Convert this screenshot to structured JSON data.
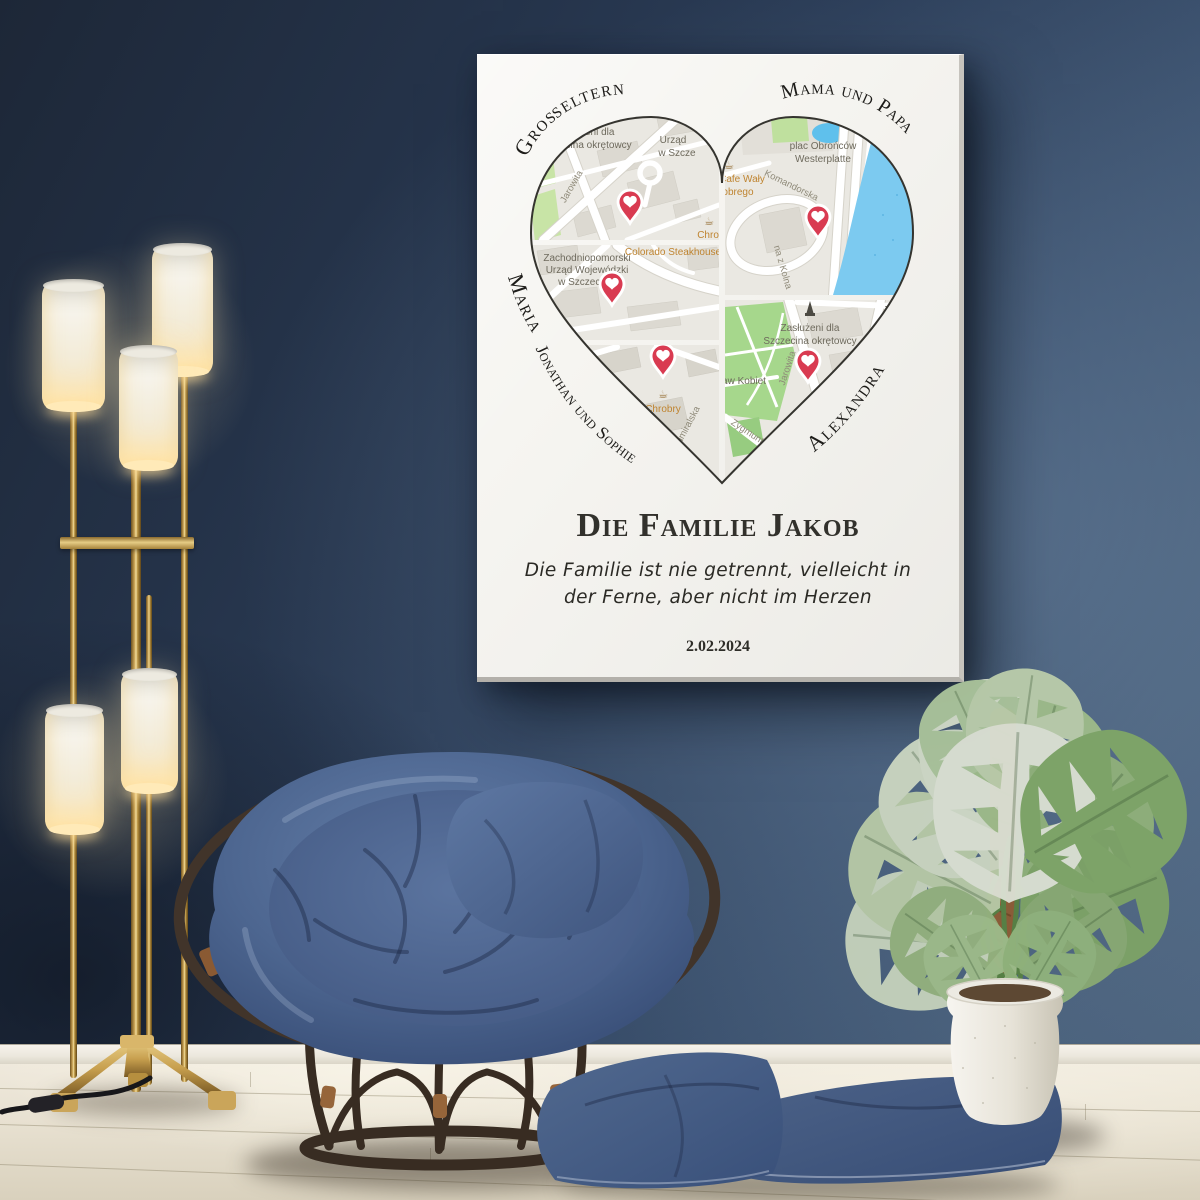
{
  "palette": {
    "wall_navy": "#2e4058",
    "floor_cream": "#e9e3d4",
    "poster_white": "#f6f5f1",
    "cushion_blue": "#4a6189",
    "pillow_blue": "#40577e",
    "lamp_gold": "#c6a055",
    "rattan_brown": "#3b2f25",
    "leaf_green": "#a9c29a",
    "map_water_blue": "#7ccaf0",
    "map_park_green": "#b5dc9a",
    "pin_red": "#d93b51",
    "map_poi_orange": "#bf8430",
    "text_dark": "#2c2b26"
  },
  "poster": {
    "names": {
      "grosseltern": "Großeltern",
      "mama_und_papa": "Mama und Papa",
      "maria": "Maria",
      "alexandra": "Alexandra",
      "jonathan_und_sophie": "Jonathan und Sophie"
    },
    "title": "Die Familie Jakob",
    "subtitle": {
      "line1": "Die Familie ist nie getrennt, vielleicht in",
      "line2": "der Ferne, aber nicht im Herzen"
    },
    "date": "2.02.2024",
    "icons": {
      "cafe_glyph": "☕"
    },
    "maps": {
      "top_left": {
        "area1": "Zasłużeni dla",
        "area2": "Szczecina okrętowcy",
        "urzad1": "Urząd",
        "urzad2": "w Szcze",
        "jarowita": "Jarowita",
        "chrobry": "Chrobry"
      },
      "middle_left": {
        "office1": "Zachodniopomorski",
        "office2": "Urząd Wojewódzki",
        "office3": "w Szczecinie",
        "steakhouse": "Colorado Steakhouse"
      },
      "bottom_left": {
        "chrobry": "Chrobry",
        "admiralska": "Admiralska"
      },
      "top_right": {
        "square1": "plac Obrońców",
        "square2": "Westerplatte",
        "cafe1": "Cafe Wały",
        "cafe2": "obrego",
        "komandorska": "Komandorska",
        "kolna": "na z Kolna"
      },
      "bottom_right": {
        "area1": "Zasłużeni dla",
        "area2": "Szczecina okrętowcy",
        "edge1": "Zachodni",
        "edge2": "Urząd",
        "edge3": "w",
        "praw": "Praw Kobiet",
        "jarowita": "Jarowita",
        "zygmunta": "Zygmunta Sta"
      }
    }
  }
}
